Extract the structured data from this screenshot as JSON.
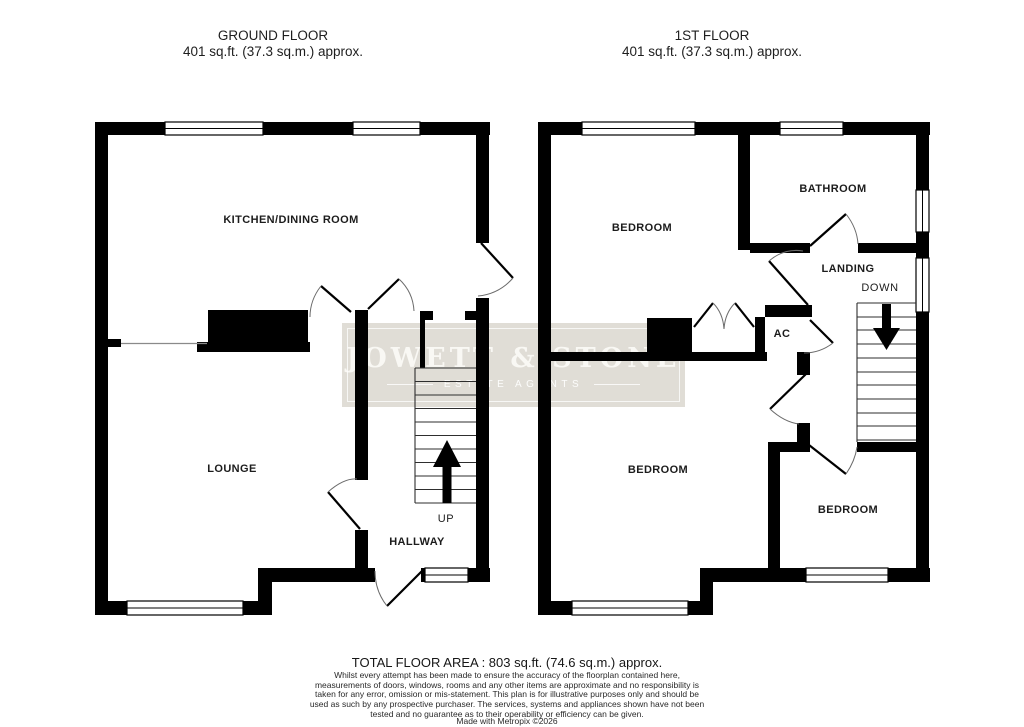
{
  "ground_floor": {
    "title": "GROUND FLOOR",
    "area_label": "401 sq.ft. (37.3 sq.m.) approx.",
    "rooms": {
      "kitchen_dining": "KITCHEN/DINING ROOM",
      "lounge": "LOUNGE",
      "hallway": "HALLWAY",
      "stairs_direction": "UP"
    }
  },
  "first_floor": {
    "title": "1ST FLOOR",
    "area_label": "401 sq.ft. (37.3 sq.m.) approx.",
    "rooms": {
      "bedroom_front": "BEDROOM",
      "bathroom": "BATHROOM",
      "landing": "LANDING",
      "stairs_direction": "DOWN",
      "airing_cupboard": "AC",
      "bedroom_back": "BEDROOM",
      "bedroom_small": "BEDROOM"
    }
  },
  "watermark": {
    "name": "JOWETT & STONE",
    "tagline": "ESTATE AGENTS"
  },
  "footer": {
    "total_area": "TOTAL FLOOR AREA : 803 sq.ft. (74.6 sq.m.) approx.",
    "disclaimer": "Whilst every attempt has been made to ensure the accuracy of the floorplan contained here, measurements of doors, windows, rooms and any other items are approximate and no responsibility is taken for any error, omission or mis-statement. This plan is for illustrative purposes only and should be used as such by any prospective purchaser. The services, systems and appliances shown have not been tested and no guarantee as to their operability or efficiency can be given.",
    "credit": "Made with Metropix ©2026"
  },
  "colors": {
    "wall": "#000000",
    "thin_line": "#6b6b6b",
    "stair_line": "#2e2e2e",
    "watermark_bg": "#e0ddd6",
    "watermark_text": "#f9f8f4",
    "label_text": "#1c1c1c"
  }
}
